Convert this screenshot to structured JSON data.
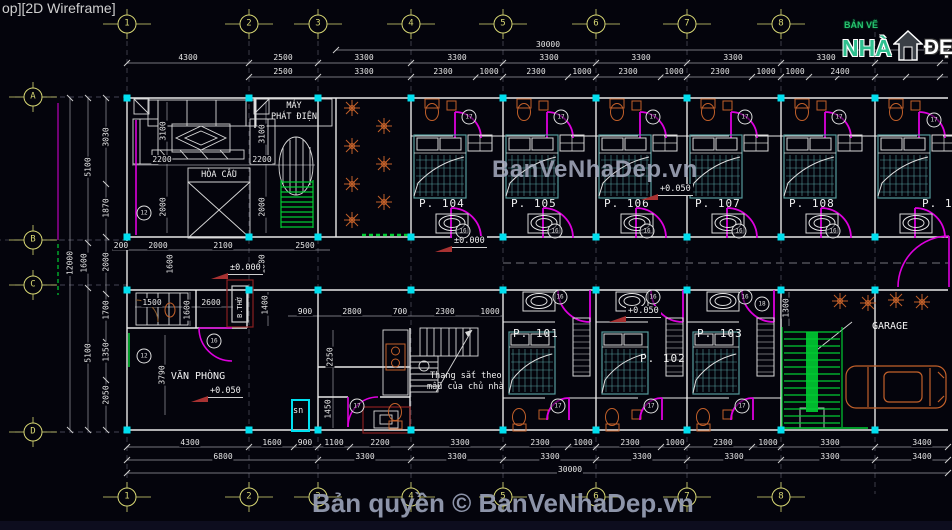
{
  "viewport_label": "op][2D Wireframe]",
  "logo": {
    "prefix": "BẢN VẼ",
    "brand": "NHÀ",
    "suffix": "ĐẸP"
  },
  "watermark": {
    "center": "BanVeNhaDep.vn",
    "copyright": "Bản quyền © BanVeNhaDep.vn"
  },
  "colors": {
    "accent_yellow": "#d8d874",
    "node_cyan": "#00e0f0",
    "door_magenta": "#dd00dd",
    "bed_teal": "#569b9b",
    "fixture_orange": "#c2602a",
    "stair_green": "#00cc33",
    "dim_text": "#e6e6e6",
    "watermark_gray": "#a8aec2"
  },
  "grid": {
    "columns": [
      {
        "label": "1",
        "x": 127
      },
      {
        "label": "2",
        "x": 249
      },
      {
        "label": "3",
        "x": 318
      },
      {
        "label": "4",
        "x": 411
      },
      {
        "label": "5",
        "x": 503
      },
      {
        "label": "6",
        "x": 596
      },
      {
        "label": "7",
        "x": 687
      },
      {
        "label": "8",
        "x": 781
      }
    ],
    "rows": [
      {
        "label": "A",
        "y": 97
      },
      {
        "label": "B",
        "y": 240
      },
      {
        "label": "C",
        "y": 285
      },
      {
        "label": "D",
        "y": 432
      }
    ]
  },
  "rooms": {
    "top": [
      {
        "label": "P. 104",
        "x1": 411,
        "x2": 503
      },
      {
        "label": "P. 105",
        "x1": 503,
        "x2": 596
      },
      {
        "label": "P. 106",
        "x1": 596,
        "x2": 687
      },
      {
        "label": "P. 107",
        "x1": 687,
        "x2": 781
      },
      {
        "label": "P. 108",
        "x1": 781,
        "x2": 875
      },
      {
        "label": "P. 109",
        "x1": 875,
        "x2": 968,
        "lx": 47
      }
    ],
    "bottom": [
      {
        "label": "P. 101",
        "x1": 503,
        "x2": 596,
        "ly": 327
      },
      {
        "label": "P. 102",
        "x1": 596,
        "x2": 687,
        "lx": 44,
        "ly": 352
      },
      {
        "label": "P. 103",
        "x1": 687,
        "x2": 781,
        "ly": 327
      }
    ],
    "areas": [
      {
        "label": "GARAGE",
        "x": 890,
        "y": 321,
        "fs": 10
      },
      {
        "label": "VĂN PHÒNG",
        "x": 198,
        "y": 371,
        "fs": 10
      },
      {
        "label": "HÒA CẦU",
        "x": 219,
        "y": 170,
        "fs": 8.5
      },
      {
        "label": "MÁY",
        "x": 294,
        "y": 101,
        "fs": 8.5
      },
      {
        "label": "PHÁT ĐIỆN",
        "x": 294,
        "y": 112,
        "fs": 8.5
      }
    ]
  },
  "levels": [
    {
      "t": "±0.000",
      "x": 228,
      "y": 263
    },
    {
      "t": "±0.000",
      "x": 452,
      "y": 236
    },
    {
      "t": "+0.050",
      "x": 658,
      "y": 184
    },
    {
      "t": "+0.050",
      "x": 626,
      "y": 306
    },
    {
      "t": "+0.050",
      "x": 208,
      "y": 386
    }
  ],
  "notes": {
    "stair1": "Thang sắt theo",
    "stair2": "mẫu của chủ nhà",
    "sn": "sn",
    "altar": "B.THỜ"
  },
  "dims": {
    "top": [
      [
        "30000",
        548,
        45
      ],
      [
        "4300",
        188,
        58
      ],
      [
        "2500",
        283,
        58
      ],
      [
        "3300",
        364,
        58
      ],
      [
        "3300",
        457,
        58
      ],
      [
        "3300",
        549,
        58
      ],
      [
        "3300",
        641,
        58
      ],
      [
        "3300",
        733,
        58
      ],
      [
        "3300",
        826,
        58
      ],
      [
        "2500",
        283,
        72
      ],
      [
        "3300",
        364,
        72
      ],
      [
        "2300",
        443,
        72
      ],
      [
        "1000",
        489,
        72
      ],
      [
        "2300",
        536,
        72
      ],
      [
        "1000",
        582,
        72
      ],
      [
        "2300",
        628,
        72
      ],
      [
        "1000",
        674,
        72
      ],
      [
        "2300",
        720,
        72
      ],
      [
        "1000",
        766,
        72
      ],
      [
        "1000",
        795,
        72
      ],
      [
        "2400",
        840,
        72
      ]
    ],
    "bottom": [
      [
        "4300",
        190,
        443
      ],
      [
        "1600",
        272,
        443
      ],
      [
        "900",
        305,
        443
      ],
      [
        "1100",
        334,
        443
      ],
      [
        "2200",
        380,
        443
      ],
      [
        "3300",
        460,
        443
      ],
      [
        "2300",
        540,
        443
      ],
      [
        "1000",
        583,
        443
      ],
      [
        "2300",
        630,
        443
      ],
      [
        "1000",
        675,
        443
      ],
      [
        "2300",
        723,
        443
      ],
      [
        "1000",
        768,
        443
      ],
      [
        "3300",
        830,
        443
      ],
      [
        "3400",
        922,
        443
      ],
      [
        "6800",
        223,
        457
      ],
      [
        "3300",
        365,
        457
      ],
      [
        "3300",
        457,
        457
      ],
      [
        "3300",
        550,
        457
      ],
      [
        "3300",
        642,
        457
      ],
      [
        "3300",
        734,
        457
      ],
      [
        "3300",
        830,
        457
      ],
      [
        "3400",
        922,
        457
      ],
      [
        "30000",
        570,
        470
      ]
    ],
    "left": [
      [
        "12000",
        70,
        263,
        "v"
      ],
      [
        "1600",
        84,
        263,
        "v"
      ],
      [
        "5100",
        88,
        167,
        "v"
      ],
      [
        "5100",
        88,
        353,
        "v"
      ],
      [
        "3030",
        106,
        137,
        "v"
      ],
      [
        "1870",
        106,
        208,
        "v"
      ],
      [
        "2000",
        106,
        262,
        "v"
      ],
      [
        "1700",
        106,
        310,
        "v"
      ],
      [
        "1350",
        106,
        352,
        "v"
      ],
      [
        "2050",
        106,
        395,
        "v"
      ]
    ],
    "inner": [
      [
        "2200",
        162,
        160
      ],
      [
        "2200",
        262,
        160
      ],
      [
        "3100",
        163,
        131,
        "v"
      ],
      [
        "3100",
        262,
        134,
        "v"
      ],
      [
        "2000",
        163,
        207,
        "v"
      ],
      [
        "2000",
        262,
        207,
        "v"
      ],
      [
        "200",
        121,
        246
      ],
      [
        "2000",
        158,
        246
      ],
      [
        "2100",
        223,
        246
      ],
      [
        "2500",
        305,
        246
      ],
      [
        "1600",
        170,
        264,
        "v"
      ],
      [
        "1800",
        262,
        264,
        "v"
      ],
      [
        "1600",
        187,
        310,
        "v"
      ],
      [
        "1400",
        265,
        305,
        "v"
      ],
      [
        "1500",
        152,
        303
      ],
      [
        "2600",
        211,
        303
      ],
      [
        "3790",
        162,
        375,
        "v"
      ],
      [
        "900",
        305,
        312
      ],
      [
        "2800",
        352,
        312
      ],
      [
        "700",
        400,
        312
      ],
      [
        "2300",
        445,
        312
      ],
      [
        "1000",
        490,
        312
      ],
      [
        "2250",
        330,
        357,
        "v"
      ],
      [
        "1450",
        328,
        409,
        "v"
      ],
      [
        "1300",
        786,
        308,
        "v"
      ]
    ]
  },
  "door_tags": [
    [
      "17",
      469,
      117
    ],
    [
      "17",
      561,
      117
    ],
    [
      "17",
      653,
      117
    ],
    [
      "17",
      745,
      117
    ],
    [
      "17",
      839,
      117
    ],
    [
      "17",
      934,
      120
    ],
    [
      "16",
      463,
      231
    ],
    [
      "16",
      555,
      231
    ],
    [
      "16",
      647,
      231
    ],
    [
      "16",
      739,
      231
    ],
    [
      "16",
      833,
      231
    ],
    [
      "16",
      560,
      297
    ],
    [
      "16",
      653,
      297
    ],
    [
      "16",
      745,
      297
    ],
    [
      "17",
      558,
      406
    ],
    [
      "17",
      651,
      406
    ],
    [
      "17",
      742,
      406
    ],
    [
      "16",
      214,
      341
    ],
    [
      "12",
      144,
      356
    ],
    [
      "12",
      144,
      213
    ],
    [
      "17",
      357,
      406
    ],
    [
      "18",
      762,
      304
    ]
  ]
}
